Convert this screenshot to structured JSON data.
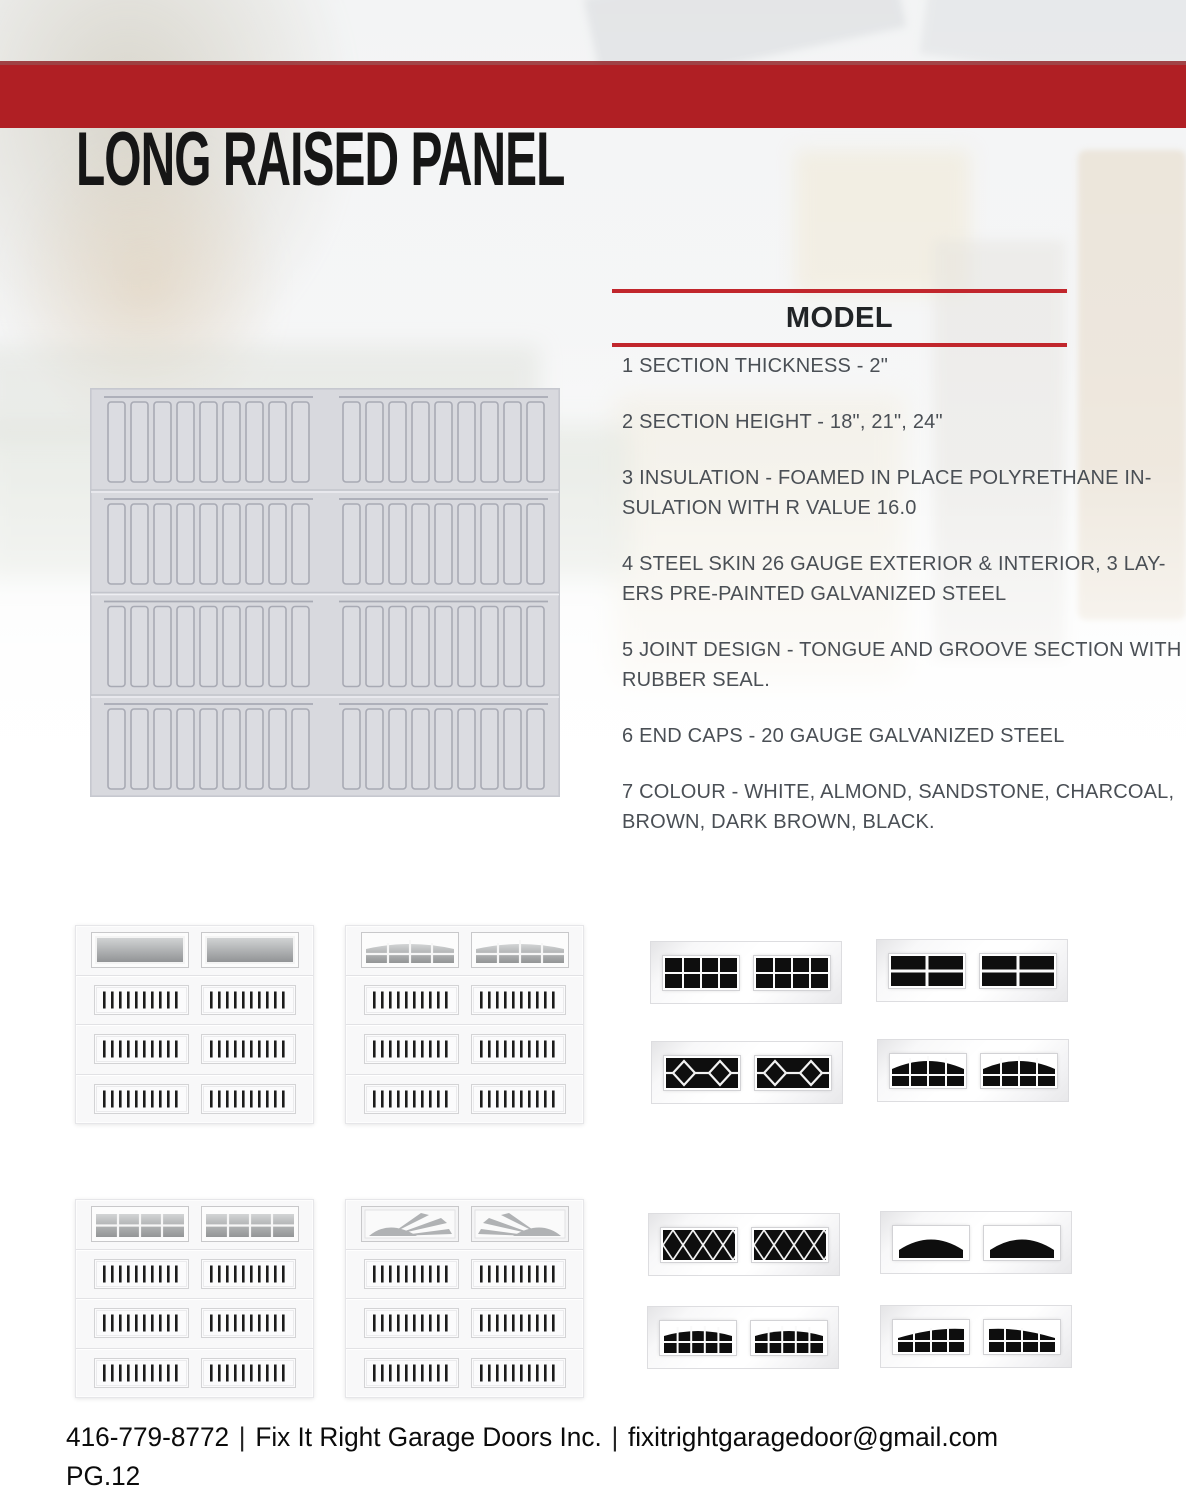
{
  "header": {
    "title": "LONG RAISED PANEL"
  },
  "model": {
    "heading": "MODEL",
    "specs": [
      {
        "lines": [
          "1 SECTION THICKNESS - 2\""
        ]
      },
      {
        "lines": [
          "2 SECTION HEIGHT - 18\", 21\", 24\""
        ]
      },
      {
        "lines": [
          "3 INSULATION - FOAMED IN PLACE POLYRETHANE IN-",
          "SULATION WITH R VALUE 16.0"
        ]
      },
      {
        "lines": [
          "4 STEEL SKIN 26 GAUGE EXTERIOR & INTERIOR, 3 LAY-",
          "ERS PRE-PAINTED GALVANIZED STEEL"
        ]
      },
      {
        "lines": [
          "5 JOINT DESIGN - TONGUE AND GROOVE SECTION WITH",
          "RUBBER SEAL."
        ]
      },
      {
        "lines": [
          "6 END CAPS - 20 GAUGE GALVANIZED STEEL"
        ]
      },
      {
        "lines": [
          "7 COLOUR - WHITE, ALMOND, SANDSTONE, CHARCOAL,",
          "BROWN, DARK BROWN, BLACK."
        ]
      }
    ]
  },
  "gallery": {
    "door_thumbnails": [
      {
        "window_style": "plain-glass"
      },
      {
        "window_style": "arched-grid"
      },
      {
        "window_style": "square-grid"
      },
      {
        "window_style": "sunburst"
      }
    ],
    "window_inserts": [
      {
        "style": "colonial-grid-8-pane"
      },
      {
        "style": "cross-4-pane"
      },
      {
        "style": "double-diamond"
      },
      {
        "style": "cathedral-arch-grid"
      },
      {
        "style": "diamond-lattice"
      },
      {
        "style": "plain-arch"
      },
      {
        "style": "arched-grid-10-pane"
      },
      {
        "style": "wide-arch-grid"
      }
    ]
  },
  "footer": {
    "phone": "416-779-8772",
    "separator": "|",
    "company": "Fix It Right Garage Doors Inc.",
    "email": "fixitrightgaragedoor@gmail.com",
    "page_number": "PG.12"
  },
  "colors": {
    "accent_red": "#b01f24",
    "accent_red_rule": "#c1262c",
    "title_black": "#161616",
    "spec_text": "#4a4f55",
    "door_gray": "#d8d9de"
  }
}
